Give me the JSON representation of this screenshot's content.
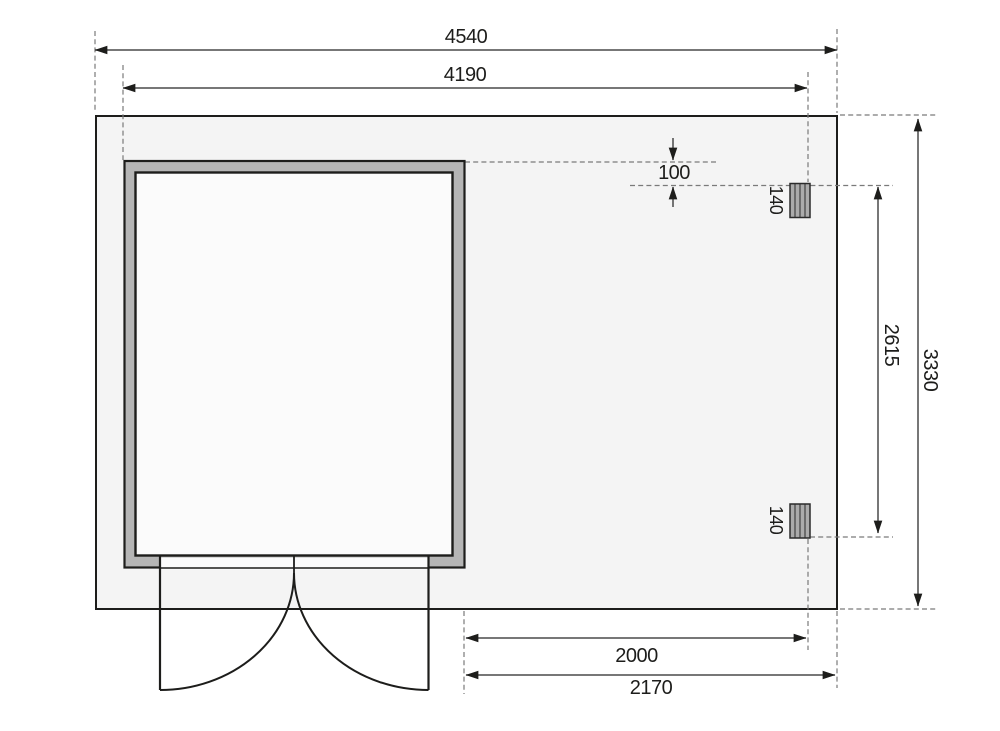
{
  "drawing": {
    "type": "garden-house-floor-plan",
    "dimensions_mm": {
      "overall_width": "4540",
      "inner_width": "4190",
      "overall_depth": "3330",
      "post_span": "2615",
      "roof_edge_offset": "100",
      "post_size_top": "140",
      "post_size_bottom": "140",
      "annex_width": "2000",
      "annex_overall_width": "2170"
    }
  },
  "colors": {
    "page_bg": "#ffffff",
    "plan_fill": "#f4f4f4",
    "wall_fill": "#b5b5b5",
    "room_fill": "#fbfbfb",
    "post_fill": "#ababab",
    "outline": "#1d1d1b",
    "dim_line": "#4a4a4a",
    "ext_line": "#7a7a7a",
    "text": "#1d1d1b"
  }
}
